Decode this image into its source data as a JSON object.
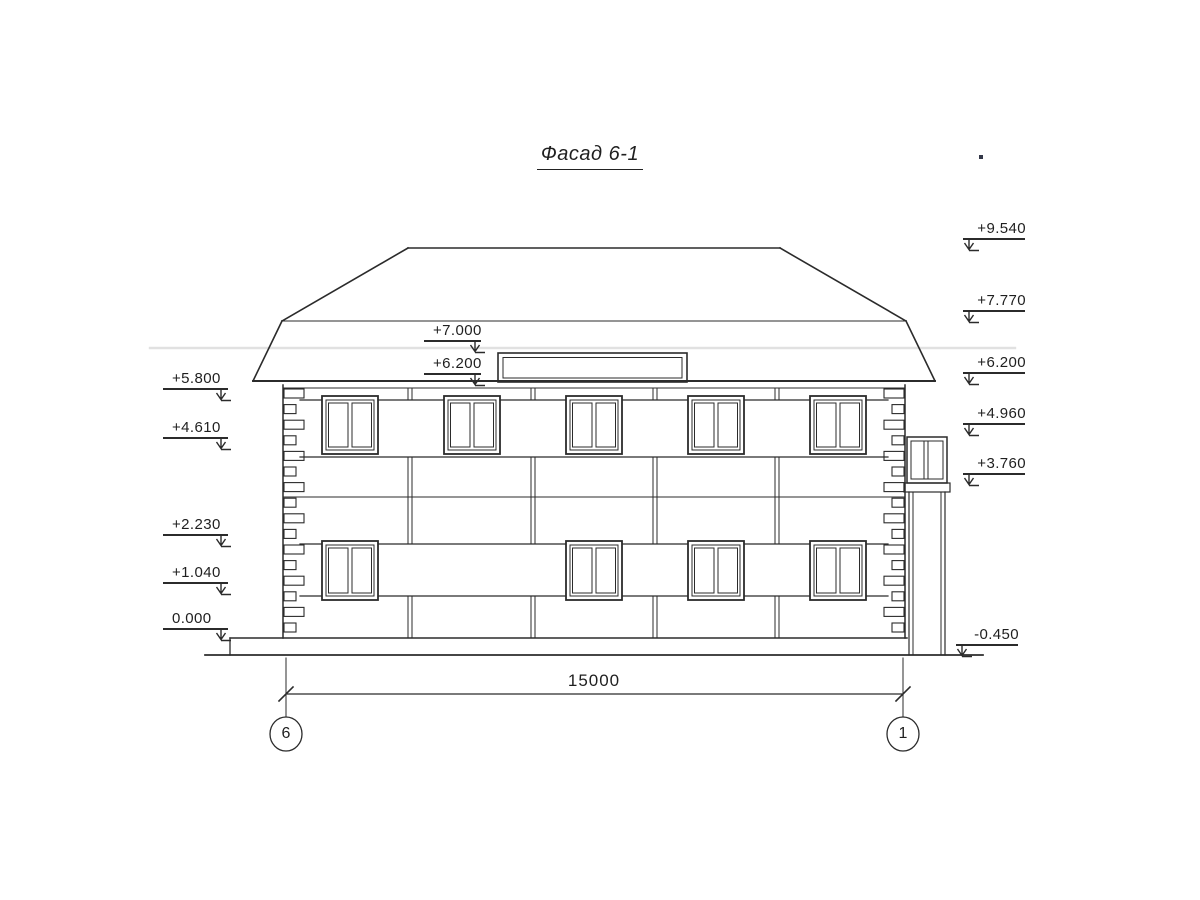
{
  "title": {
    "text": "Фасад 6-1"
  },
  "dimension": {
    "value": "15000"
  },
  "axes": {
    "left": "6",
    "right": "1"
  },
  "elevation_marks": {
    "left": [
      {
        "label": "+5.800"
      },
      {
        "label": "+4.610"
      },
      {
        "label": "+2.230"
      },
      {
        "label": "+1.040"
      },
      {
        "label": "0.000"
      }
    ],
    "center": [
      {
        "label": "+7.000"
      },
      {
        "label": "+6.200"
      }
    ],
    "right": [
      {
        "label": "+9.540"
      },
      {
        "label": "+7.770"
      },
      {
        "label": "+6.200"
      },
      {
        "label": "+4.960"
      },
      {
        "label": "+3.760"
      },
      {
        "label": "-0.450"
      }
    ]
  },
  "colors": {
    "line": "#2b2b2b",
    "background": "#ffffff",
    "scan_artifact": "#c9c9c9"
  }
}
